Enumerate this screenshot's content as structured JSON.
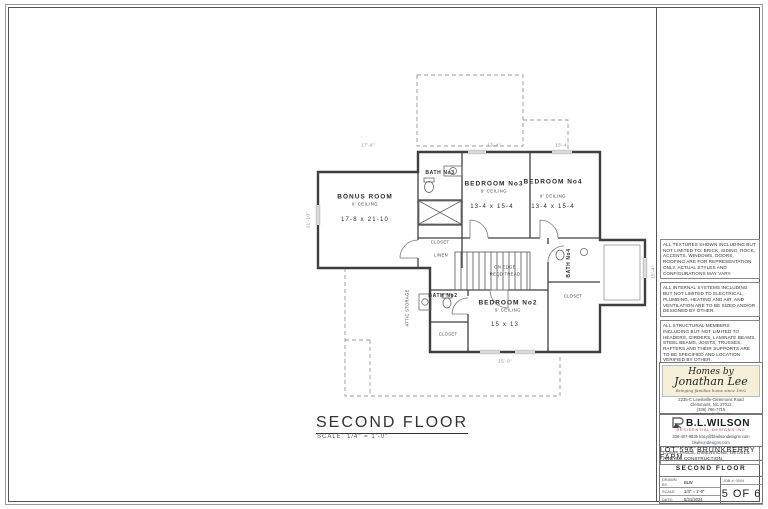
{
  "drawing": {
    "title": "SECOND FLOOR",
    "scale": "SCALE: 1/4\" = 1'-0\"",
    "rooms": [
      {
        "name": "BONUS ROOM",
        "ceiling": "9' CEILING",
        "size": "17-8 x 21-10"
      },
      {
        "name": "BATH No3"
      },
      {
        "name": "BEDROOM No3",
        "ceiling": "9' CEILING",
        "size": "13-4 x 15-4"
      },
      {
        "name": "BEDROOM No4",
        "ceiling": "9' CEILING",
        "size": "13-4 x 15-4"
      },
      {
        "name": "BEDROOM No2",
        "ceiling": "9' CEILING",
        "size": "15 x 13"
      },
      {
        "name": "BATH No2"
      },
      {
        "name": "BATH No4"
      }
    ],
    "labels": {
      "attic_storage": "ATTIC STORAGE",
      "closet1": "CLOSET",
      "closet2": "CLOSET",
      "closet3": "CLOSET",
      "linen": "LINEN",
      "stairs_line1": "ON EDGE",
      "stairs_line2": "REQD TREAD"
    },
    "dimensions": {
      "top_left": "17'-8\"",
      "top_mid": "13'-4\"",
      "top_right": "13'-4\"",
      "left": "21'-10\"",
      "right": "15'-4\"",
      "bottom": "15'-0\""
    }
  },
  "notes": [
    "ALL TEXTURES SHOWN INCLUDING BUT NOT LIMITED TO: BRICK, SIDING, ROCK, ACCENTS, WINDOWS, DOORS, ROOFING ARE FOR REPRESENTATION ONLY. ACTUAL STYLES AND CONFIGURATIONS MAY VARY.",
    "ALL INTERNAL SYSTEMS INCLUDING BUT NOT LIMITED TO ELECTRICAL, PLUMBING, HEATING AND AIR, AND VENTILATION ARE TO BE SIZED AND/OR DESIGNED BY OTHER.",
    "ALL STRUCTURAL MEMBERS INCLUDING BUT NOT LIMITED TO HEADERS, GIRDERS, LAMINATE BEAMS, STEEL BEAMS, JOISTS, TRUSSES, RAFTERS AND THEIR SUPPORTS ARE TO BE SPECIFIED AND LOCATION VERIFIED BY OTHER.",
    "DIMENSION NOTE: DIMENSIONS ARE FROM OUTSIDE OF SHEATHING TO FACE OF INTERIOR STUD. ALL WALLS ARE CONSIDERED 3 1/2\" UNLESS NOTED OTHERWISE.",
    "THESE DRAWINGS ARE INTENDED TO CONVEY DESIGN INTENT. THEREFORE ANY STRUCTURAL SIZING OR SPACING SHOWN IS FOR GUIDANCE AND ESTIMATION PURPOSES ONLY. THE OWNER AND/OR CONTRACTOR IS RESPONSIBLE FOR VERIFYING CODE COMPLIANCE, DIMENSIONS, DETAILS AND ALL CONSTRUCTION."
  ],
  "branding": {
    "homes_by": {
      "line1": "Homes by",
      "line2": "Jonathan Lee",
      "tagline": "Bringing families home since 1992",
      "address1": "2235-C Lewisville-Clemmons Road",
      "address2": "Clemmons, NC 27012",
      "phone": "(336) 766-7715",
      "web": "www.homesbyjlee.com"
    },
    "blwilson": {
      "name": "B.L.WILSON",
      "sub": "RESIDENTIAL DESIGNS INC",
      "contact": "336-407-9835   tracy@blwilsondesigns.com",
      "web": "blwilsondesigns.com"
    }
  },
  "titleblock": {
    "lot": "LOT 596 BRUNKBERRY FARM",
    "sheet_title": "SECOND FLOOR",
    "drawn_by_label": "DRAWN BY:",
    "drawn_by": "BLW",
    "scale_label": "SCALE:",
    "scale": "1/4\" = 1'-0\"",
    "date_label": "DATE:",
    "date": "5/31/2024",
    "job_label": "JOB #:",
    "job": "0004",
    "page": "5 OF 6"
  }
}
